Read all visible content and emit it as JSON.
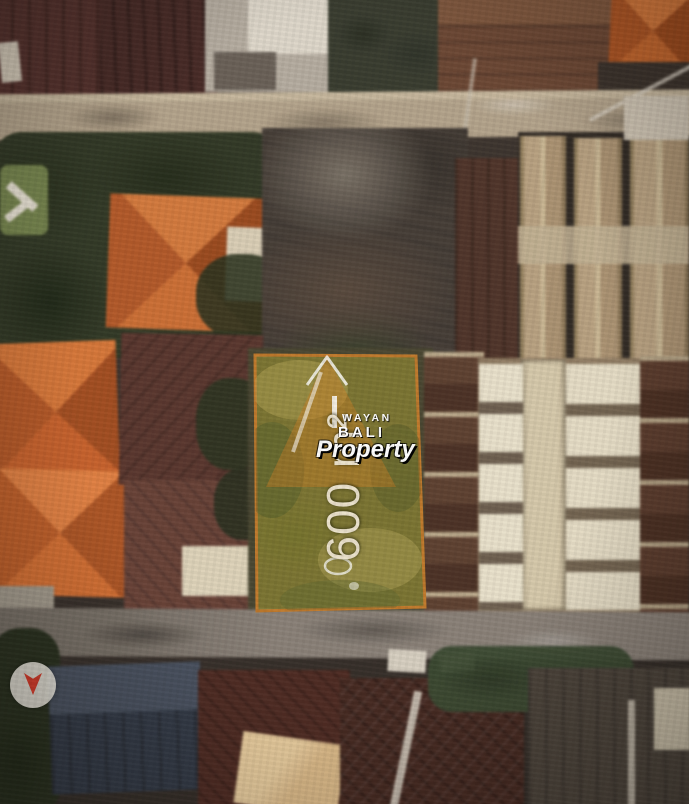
{
  "scene": {
    "description": "Aerial satellite view of a residential neighborhood with a highlighted land plot for sale",
    "plot": {
      "area_label": "600 m²",
      "area_value": 600,
      "area_unit": "m²",
      "fill_color": "#9a9438",
      "border_color": "#c07a2c"
    },
    "watermark": {
      "line1": "WAYAN",
      "line2": "BALI",
      "line3": "Property",
      "text_color": "#ffffff",
      "logo": "mountain-a-triangle",
      "logo_color": "#ce7e24"
    },
    "marker": {
      "style": "white-circle-red-arrow",
      "circle_color": "#e9e5dc",
      "arrow_color": "#d23b2a"
    }
  }
}
